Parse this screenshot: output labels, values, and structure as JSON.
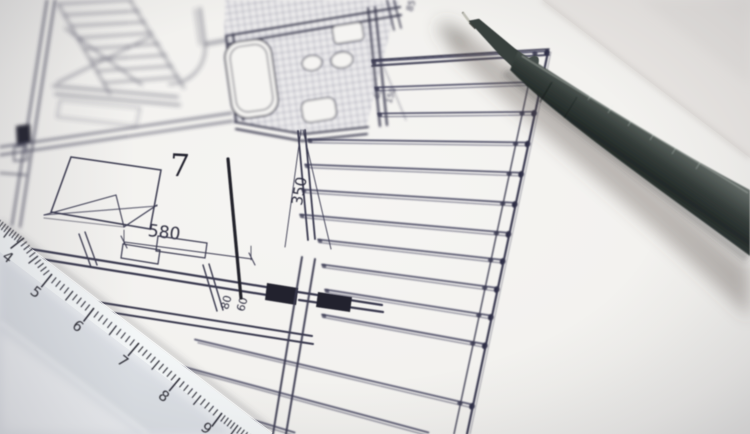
{
  "plan": {
    "room_number": "7",
    "dimensions": {
      "d580": "580",
      "d350": "350",
      "d80": "80",
      "d60": "60",
      "d85": "85",
      "d40": "40",
      "d150": "150"
    }
  },
  "ruler": {
    "numbers": [
      "4",
      "5",
      "6",
      "7",
      "8",
      "9"
    ]
  },
  "colors": {
    "paper": "#f3f2f0",
    "table_background": "#e9e6e3",
    "ink": "#3a3a50",
    "ink_dark": "#22222e",
    "hatch": "#3c3c58",
    "ruler_body": "#e7eaee",
    "ruler_tick": "#262630",
    "pen_dark": "#232a28",
    "pen_mid": "#4a524f",
    "pen_light": "#79817d",
    "needle": "#bfbfb6"
  }
}
